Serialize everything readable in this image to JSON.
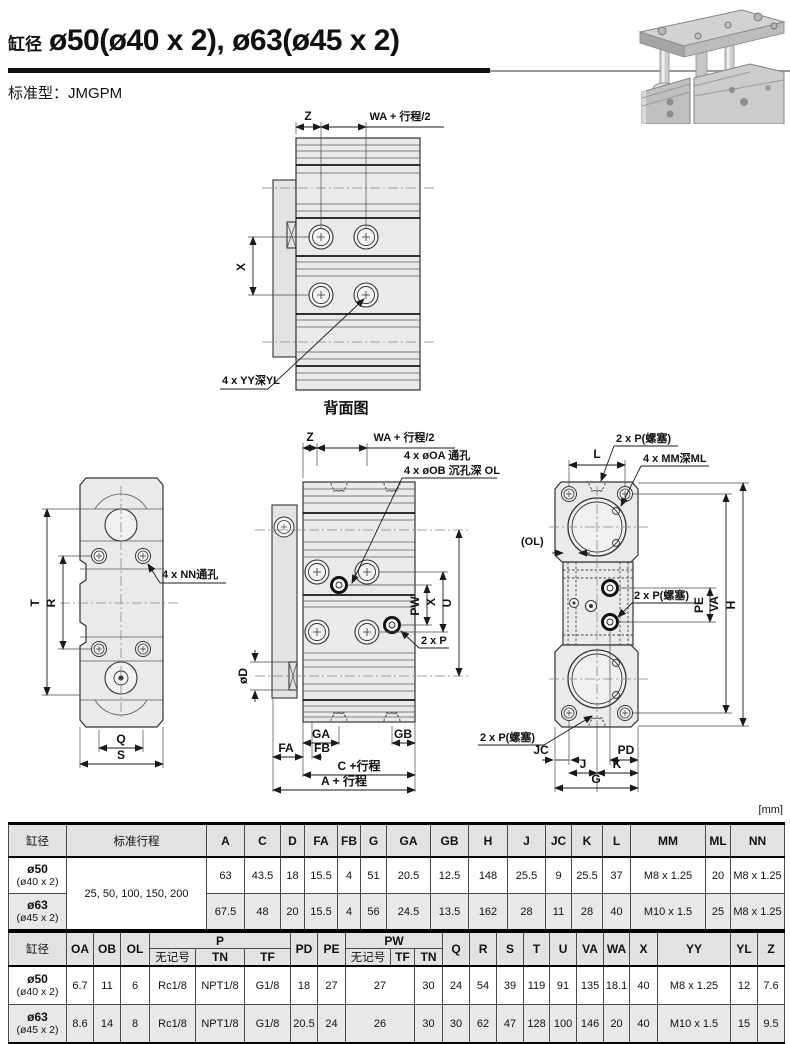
{
  "page": {
    "title_prefix": "缸径",
    "title": "ø50(ø40 x 2), ø63(ø45 x 2)",
    "model_label": "标准型：",
    "model_value": "JMGPM",
    "units_note": "[mm]"
  },
  "drawings": {
    "back_view": {
      "caption": "背面图",
      "dim_z": "Z",
      "dim_wa": "WA + 行程/2",
      "dim_x": "X",
      "callout_yy": "4 x YY深YL"
    },
    "side_view": {
      "dim_t": "T",
      "dim_r": "R",
      "dim_q": "Q",
      "dim_s": "S",
      "callout_nn": "4 x NN通孔"
    },
    "front_view": {
      "dim_z": "Z",
      "dim_wa": "WA + 行程/2",
      "callout_oa": "4 x øOA 通孔",
      "callout_ob": "4 x øOB 沉孔深 OL",
      "dim_pw": "PW",
      "dim_x": "X",
      "dim_u": "U",
      "callout_p": "2 x P",
      "dim_d": "øD",
      "dim_ga": "GA",
      "dim_gb": "GB",
      "dim_fa": "FA",
      "dim_fb": "FB",
      "dim_c": "C +行程",
      "dim_a": "A + 行程"
    },
    "end_view": {
      "dim_l": "L",
      "callout_p_top": "2 x P(螺塞)",
      "callout_mm": "4 x MM深ML",
      "dim_ol": "(OL)",
      "callout_p_mid": "2 x P(螺塞)",
      "dim_pe": "PE",
      "dim_va": "VA",
      "dim_h": "H",
      "callout_p_bottom": "2 x P(螺塞)",
      "dim_jc": "JC",
      "dim_j": "J",
      "dim_k": "K",
      "dim_pd": "PD",
      "dim_g": "G"
    }
  },
  "table1": {
    "headers": [
      "缸径",
      "标准行程",
      "A",
      "C",
      "D",
      "FA",
      "FB",
      "G",
      "GA",
      "GB",
      "H",
      "J",
      "JC",
      "K",
      "L",
      "MM",
      "ML",
      "NN"
    ],
    "stroke_options": "25, 50, 100, 150, 200",
    "rows": [
      {
        "bore": "ø50",
        "bore_sub": "(ø40 x 2)",
        "values": [
          "63",
          "43.5",
          "18",
          "15.5",
          "4",
          "51",
          "20.5",
          "12.5",
          "148",
          "25.5",
          "9",
          "25.5",
          "37",
          "M8 x 1.25",
          "20",
          "M8 x 1.25"
        ]
      },
      {
        "bore": "ø63",
        "bore_sub": "(ø45 x 2)",
        "values": [
          "67.5",
          "48",
          "20",
          "15.5",
          "4",
          "56",
          "24.5",
          "13.5",
          "162",
          "28",
          "11",
          "28",
          "40",
          "M10 x 1.5",
          "25",
          "M8 x 1.25"
        ]
      }
    ]
  },
  "table2": {
    "headers_top": [
      "缸径",
      "OA",
      "OB",
      "OL",
      "P",
      "PD",
      "PE",
      "PW",
      "Q",
      "R",
      "S",
      "T",
      "U",
      "VA",
      "WA",
      "X",
      "YY",
      "YL",
      "Z"
    ],
    "p_sub": [
      "无记号",
      "TN",
      "TF"
    ],
    "pw_sub": [
      "无记号",
      "TF",
      "TN"
    ],
    "rows": [
      {
        "bore": "ø50",
        "bore_sub": "(ø40 x 2)",
        "values": [
          "6.7",
          "11",
          "6",
          "Rc1/8",
          "NPT1/8",
          "G1/8",
          "18",
          "27",
          "27",
          "30",
          "24",
          "54",
          "39",
          "119",
          "91",
          "135",
          "18.1",
          "40",
          "M8 x 1.25",
          "12",
          "7.6"
        ]
      },
      {
        "bore": "ø63",
        "bore_sub": "(ø45 x 2)",
        "values": [
          "8.6",
          "14",
          "8",
          "Rc1/8",
          "NPT1/8",
          "G1/8",
          "20.5",
          "24",
          "26",
          "30",
          "30",
          "62",
          "47",
          "128",
          "100",
          "146",
          "20",
          "40",
          "M10 x 1.5",
          "15",
          "9.5"
        ]
      }
    ]
  }
}
